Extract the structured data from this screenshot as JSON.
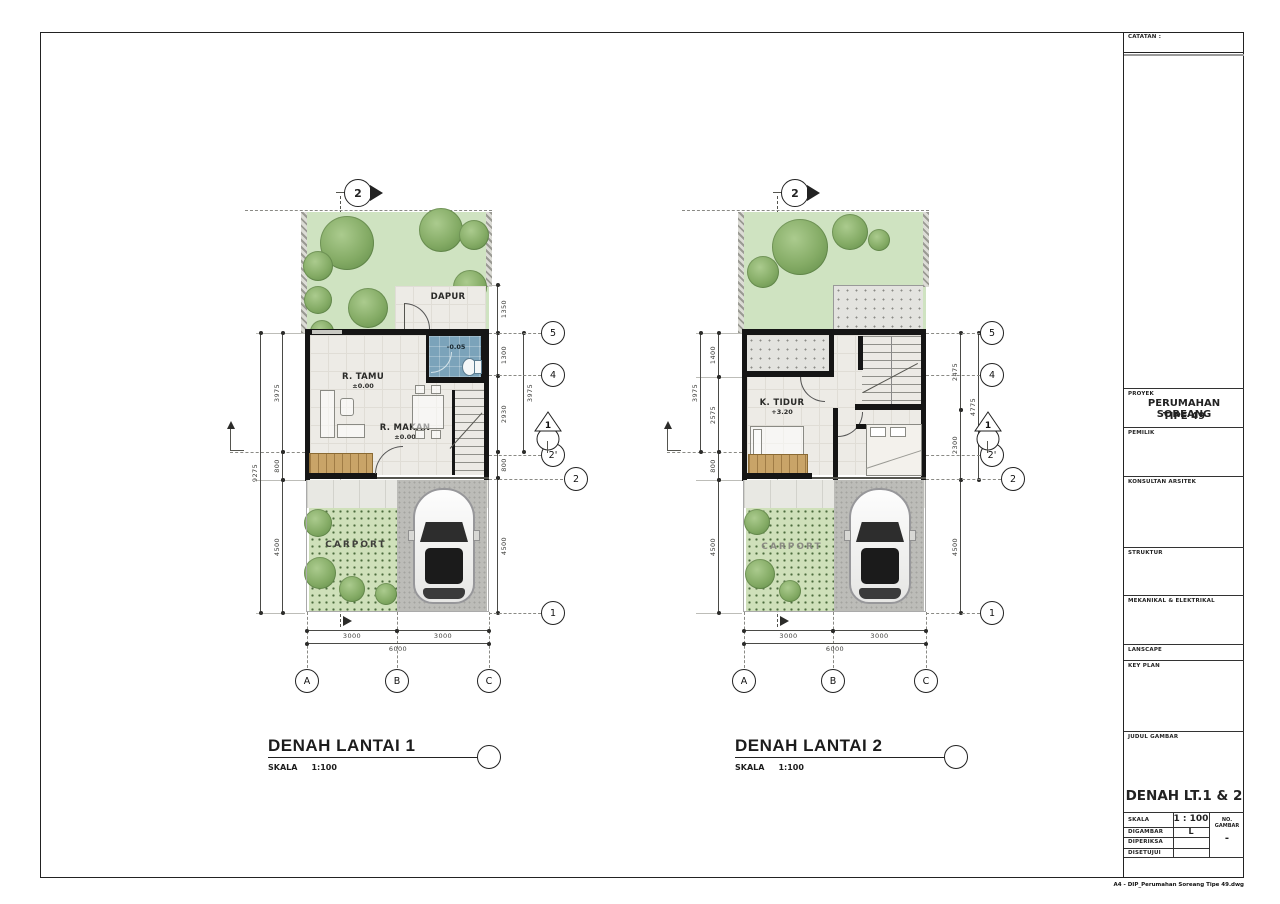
{
  "sheet": {
    "catatan_label": "CATATAN :",
    "filename": "A4 - DIP_Perumahan Soreang Tipe 49.dwg"
  },
  "titleblock": {
    "proyek_label": "PROYEK",
    "proyek_name": "PERUMAHAN SOREANG",
    "proyek_type": "TIPE 49",
    "pemilik_label": "PEMILIK",
    "konsultan_label": "KONSULTAN ARSITEK",
    "struktur_label": "STRUKTUR",
    "mekanikal_label": "MEKANIKAL & ELEKTRIKAL",
    "lanscape_label": "LANSCAPE",
    "keyplan_label": "KEY PLAN",
    "judul_label": "JUDUL GAMBAR",
    "judul_value": "DENAH LT.1 & 2",
    "skala_label": "SKALA",
    "skala_value": "1 : 100",
    "no_gambar_label": "NO. GAMBAR",
    "no_gambar_value": "-",
    "digambar_label": "DIGAMBAR",
    "digambar_value": "L",
    "diperiksa_label": "DIPERIKSA",
    "disetujui_label": "DISETUJUI"
  },
  "plan1": {
    "title": "DENAH LANTAI 1",
    "scale_label": "SKALA",
    "scale_value": "1:100",
    "section_top_label": "2",
    "section_side_label": "1",
    "rooms": {
      "dapur": "DAPUR",
      "tamu": "R. TAMU",
      "tamu_level": "±0.00",
      "makan": "R. MAKAN",
      "makan_level": "±0.00",
      "bath_level": "-0.05",
      "carport": "CARPORT"
    },
    "dims": {
      "left_total": "9275",
      "left": [
        "3975",
        "800",
        "4500"
      ],
      "right": [
        "1350",
        "1300",
        "2930",
        "800",
        "4500"
      ],
      "right_tier": "3975",
      "bottom": [
        "3000",
        "3000"
      ],
      "bottom_total": "6000"
    },
    "grid_rows": [
      "5",
      "4",
      "2'",
      "2",
      "1"
    ],
    "grid_cols": [
      "A",
      "B",
      "C"
    ]
  },
  "plan2": {
    "title": "DENAH LANTAI 2",
    "scale_label": "SKALA",
    "scale_value": "1:100",
    "section_top_label": "2",
    "section_side_label": "1",
    "rooms": {
      "tidur1": "K. TIDUR",
      "tidur1_level": "+3.20",
      "tidur2": "K. TIDUR",
      "tidur2_level": "+3.50",
      "carport": "CARPORT"
    },
    "dims": {
      "left_tier": "3975",
      "left": [
        "1400",
        "2575",
        "800",
        "4500"
      ],
      "right": [
        "2475",
        "2300",
        "4500"
      ],
      "right_tier": "4775",
      "bottom": [
        "3000",
        "3000"
      ],
      "bottom_total": "6000"
    },
    "grid_rows": [
      "5",
      "4",
      "2'",
      "2",
      "1"
    ],
    "grid_cols": [
      "A",
      "B",
      "C"
    ]
  }
}
